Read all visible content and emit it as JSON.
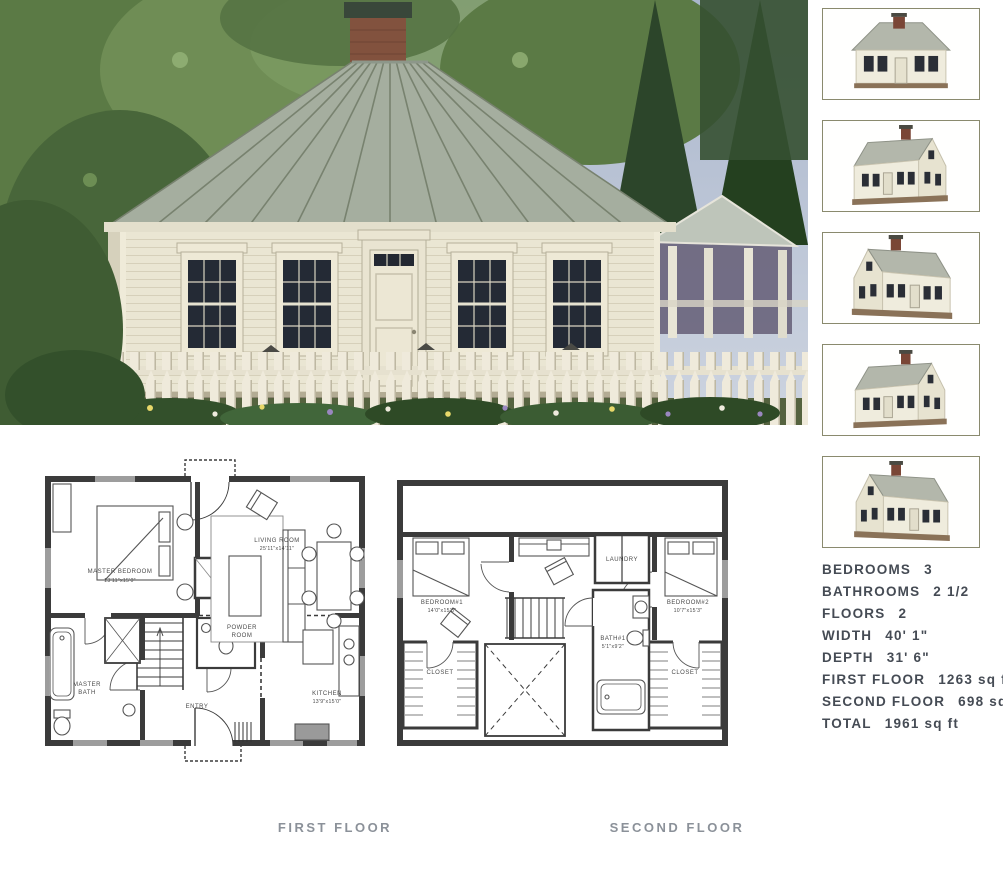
{
  "photo": {
    "description": "house-exterior-photo",
    "colors": {
      "sky": "#b6c0d4",
      "foliage": "#5b7a45",
      "roof": "#a5ae9f",
      "siding": "#eae6d3",
      "fence": "#efeadb",
      "brick": "#82523e"
    }
  },
  "thumbnails": {
    "border_color": "#8a8a6e",
    "items": [
      {
        "icon": "house-3d-front-view"
      },
      {
        "icon": "house-3d-front-left-view"
      },
      {
        "icon": "house-3d-rear-left-view"
      },
      {
        "icon": "house-3d-front-right-view"
      },
      {
        "icon": "house-3d-rear-right-view"
      }
    ]
  },
  "plans": {
    "first": {
      "caption": "FIRST FLOOR",
      "rooms": {
        "master_bedroom": {
          "name": "MASTER BEDROOM",
          "dims": "13'11\"x15'0\""
        },
        "living_room": {
          "name": "LIVING ROOM",
          "dims": "25'11\"x14'11\""
        },
        "powder_room": {
          "line1": "POWDER",
          "line2": "ROOM"
        },
        "master_bath": {
          "line1": "MASTER",
          "line2": "BATH"
        },
        "entry": {
          "name": "ENTRY"
        },
        "kitchen": {
          "name": "KITCHEN",
          "dims": "13'9\"x15'0\""
        }
      }
    },
    "second": {
      "caption": "SECOND FLOOR",
      "rooms": {
        "bedroom1": {
          "name": "BEDROOM#1",
          "dims": "14'0\"x15'3\""
        },
        "laundry": {
          "name": "LAUNDRY"
        },
        "bedroom2": {
          "name": "BEDROOM#2",
          "dims": "10'7\"x15'3\""
        },
        "bath1": {
          "name": "BATH#1",
          "dims": "5'1\"x9'2\""
        },
        "closet_left": {
          "name": "CLOSET"
        },
        "closet_right": {
          "name": "CLOSET"
        }
      }
    }
  },
  "specs": {
    "rows": [
      {
        "label": "BEDROOMS",
        "value": "3"
      },
      {
        "label": "BATHROOMS",
        "value": "2 1/2"
      },
      {
        "label": "FLOORS",
        "value": "2"
      },
      {
        "label": "WIDTH",
        "value": "40' 1\""
      },
      {
        "label": "DEPTH",
        "value": "31' 6\""
      },
      {
        "label": "FIRST FLOOR",
        "value": "1263 sq ft"
      },
      {
        "label": "SECOND FLOOR",
        "value": "698 sq ft"
      },
      {
        "label": "TOTAL",
        "value": "1961 sq ft"
      }
    ]
  }
}
